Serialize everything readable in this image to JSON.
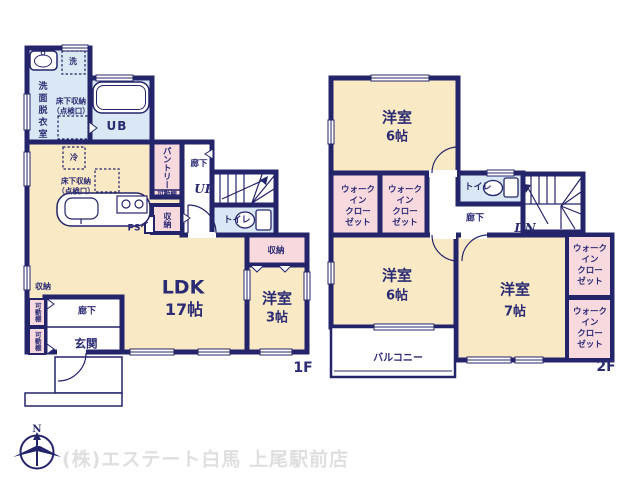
{
  "f1": {
    "floor_label": "1F",
    "washroom": "洗面脱衣室",
    "washer": "洗",
    "ufs1a": "床下収納",
    "ufs1b": "（点検口）",
    "ub": "UB",
    "fridge": "冷",
    "ufs2a": "床下収納",
    "ufs2b": "（点検口）",
    "pantry": "パントリー",
    "shelf_label": "可動棚",
    "hall_upper": "廊下",
    "up": "UP",
    "closet_mid": "収納",
    "ps": "PS",
    "toilet": "トイレ",
    "closet_west": "収納",
    "ldk": "LDK",
    "ldk_size": "17帖",
    "bed3": "洋室",
    "bed3_size": "3帖",
    "closet_genkan": "収納",
    "shelf1": "可動棚",
    "shelf2": "可動棚",
    "hall_genkan": "廊下",
    "genkan": "玄関"
  },
  "f2": {
    "floor_label": "2F",
    "bed6n": "洋室",
    "bed6n_size": "6帖",
    "wic_l1": "ウォーク",
    "wic_l2": "イン",
    "wic_l3": "クロー",
    "wic_l4": "ゼット",
    "toilet": "トイレ",
    "hall": "廊下",
    "dn": "DN",
    "bed6s": "洋室",
    "bed6s_size": "6帖",
    "balcony": "バルコニー",
    "bed7": "洋室",
    "bed7_size": "7帖"
  },
  "footer": {
    "compass_n": "N",
    "company": "(株)エステート白馬 上尾駅前店"
  }
}
